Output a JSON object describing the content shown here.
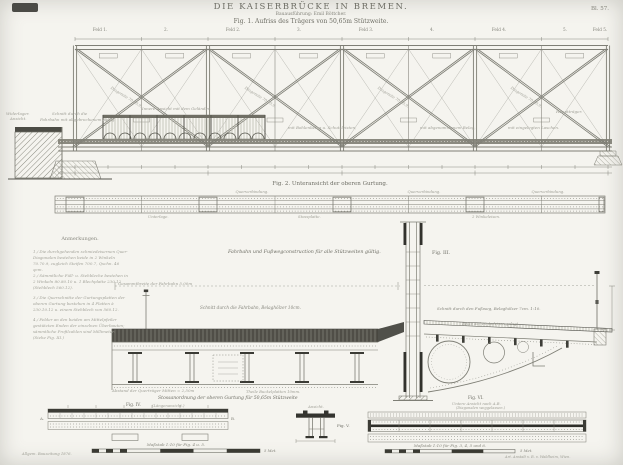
{
  "colors": {
    "paper": "#f5f4ef",
    "ink_light": "#9f9f96",
    "ink": "#85857c",
    "ink_dark": "#3a3a33"
  },
  "plate": {
    "number": "Bl. 57.",
    "title": "DIE KAISERBRÜCKE IN BREMEN.",
    "subtitle": "Bauausführung: Emil Böttcher.",
    "fig1_caption": "Fig. 1. Aufriss des Trägers von 50,65m Stützweite."
  },
  "fig1": {
    "panel_labels": [
      "Feld 1.",
      "2.",
      "Feld 2.",
      "3.",
      "Feld 3.",
      "4.",
      "Feld 4.",
      "5.",
      "Feld 5."
    ],
    "abutment_label_1": "Widerlager.",
    "abutment_label_2": "Ansicht.",
    "cut_label_1": "Schnitt durch die",
    "cut_label_2": "Fahrbahn mit abgebrochenem Belag.",
    "railing_label": "Innere Ansicht mit dem Geländer.",
    "deck_label_1": "mit Bohlenbelag u. Schutzleisten,",
    "deck_label_2": "mit abgenommenem Belag,",
    "deck_label_3": "mit eingelegten Laschen.",
    "main_girder_label": "Hauptträger.",
    "diagonal_label": "Diagonale 70.70.9."
  },
  "fig2": {
    "caption": "Fig. 2. Unteransicht der oberen Gurtung.",
    "label_top": "Querverbindung.",
    "label_bottom_1": "Unterlage.",
    "label_bottom_2": "Stossplatte.",
    "label_bottom_3": "2 Winkeleisen."
  },
  "notes": {
    "header": "Anmerkungen.",
    "items": [
      "1./ Die durchgehenden schmiedeisernen Quer-Diagonalen bestehen beide in 2 Winkeln 70.70.9, zugleich Steifen 700.7, Qschn. 46 qcm.",
      "2./ Sämmtliche Füll- u. Stehbleche bestehen in 2 Winkeln 80.80.10 u. 1 Blechplatte 230.12 (Stehblech 560.12).",
      "3./ Die Querschnitte der Gurtungsplatten der oberen Gurtung bestehen in 4 Platten à 230.10.12 u. einem Stehblech von 560.12.",
      "4./ Felder an den beiden am Mittelpfeiler gestützten Enden der einzelnen Überbauten; sämmtliche Profilzahlen sind Millimeter. (Siehe Fig. III.)"
    ]
  },
  "fig3": {
    "caption": "Fahrbahn und Fußwegconstruction für alle Stützweiten gültig.",
    "label": "Fig. III.",
    "roadway_width": "Gesammtbreite der Fahrbahn 5,00m",
    "roadway_cut": "Schnitt durch die Fahrbahn, Belaghölzer 10cm.",
    "footway_cut": "Schnitt durch den Fußweg, Belaghölzer 7cm. 1:10.",
    "footway_note": "Belag auf Winkeleisen gelegt.",
    "girder_spacing": "Abstand der Querträger Mitten = 2,50m",
    "plate_note": "Theile Buckelplatten 10mm."
  },
  "fig4": {
    "group_caption": "Stossanordnung der oberen Gurtung für 50,65m Stützweite",
    "label": "Fig. IV.",
    "sub": "(Längenansicht.)",
    "point_a": "A.",
    "point_b": "B."
  },
  "fig5": {
    "label": "Fig. V.",
    "view": "Ansicht."
  },
  "fig6": {
    "label": "Fig. VI.",
    "sub1": "Untere Ansicht nach A.B.",
    "sub2": "(Diagonalen weggelassen.)"
  },
  "scales": {
    "left_caption": "Maßstab 1:10 für Fig. 4 u. 5.",
    "left_end": "5 Met.",
    "right_caption": "Maßstab 1:10 für Fig. 3, 4, 5 und 6.",
    "right_end": "5 Met."
  },
  "imprints": {
    "left": "Allgem. Bauzeitung 1876.",
    "right": "Art. Anstalt v. R. v. Waldheim, Wien."
  }
}
